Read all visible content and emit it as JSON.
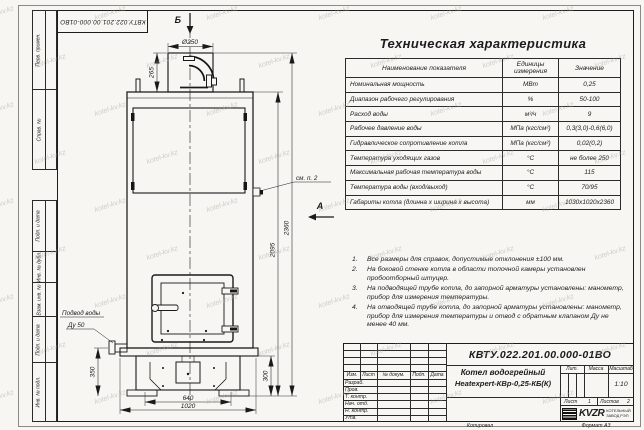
{
  "corner_stamp": "КВТУ.022.201.00.000-01ВО",
  "watermark_text": "kotel-kv.kz",
  "frame": {
    "left_labels_top": [
      "Перв. примен.",
      "Справ. №"
    ],
    "left_labels_bottom": [
      "Подп. и дата",
      "Инв. № дубл.",
      "Взам. инв. №",
      "Подп. и дата",
      "Инв. № подл."
    ]
  },
  "drawing": {
    "view_b": "Б",
    "view_a": "А",
    "dims": {
      "chimney_dia": "Ø250",
      "chimney_h": "265",
      "body_h": "2095",
      "total_h": "2360",
      "inlet_h": "350",
      "base_h": "300",
      "inner_w": "640",
      "outer_w": "1020"
    },
    "callouts": {
      "see_note": "см. п. 2",
      "water_inlet_line1": "Подвод воды",
      "water_inlet_line2": "Ду 50"
    }
  },
  "spec_table": {
    "title": "Техническая характеристика",
    "headers": [
      "Наименование показателя",
      "Единицы измерения",
      "Значение"
    ],
    "rows": [
      [
        "Номинальная мощность",
        "МВт",
        "0,25"
      ],
      [
        "Диапазон рабочего регулирования",
        "%",
        "50-100"
      ],
      [
        "Расход воды",
        "м³/ч",
        "9"
      ],
      [
        "Рабочее давление воды",
        "МПа (кгс/см²)",
        "0,3(3,0)-0,6(6,0)"
      ],
      [
        "Гидравлическое сопротивление котла",
        "МПа (кгс/см²)",
        "0,02(0,2)"
      ],
      [
        "Температура уходящих газов",
        "°С",
        "не более 250"
      ],
      [
        "Максимальная рабочая температура воды",
        "°С",
        "115"
      ],
      [
        "Температура воды (вход/выход)",
        "°С",
        "70/95"
      ],
      [
        "Габариты котла (длинна х ширина х высота)",
        "мм",
        "1030х1020х2360"
      ]
    ]
  },
  "notes": [
    "Все размеры для справок, допустимые отклонения ±100 мм.",
    "На боковой стенке котла в области топочной камеры установлен пробоотборный штуцер.",
    "На подводящей трубе котла, до запорной арматуры установлены: манометр, прибор для измерения температуры.",
    "На отводящей трубе котла, до запорной арматуры установлены: манометр, прибор для измерения температуры и отвод с обратным клапаном Ду не менее 40 мм."
  ],
  "title_block": {
    "doc_number": "КВТУ.022.201.00.000-01ВО",
    "product_line1": "Котел водогрейный",
    "product_line2": "Heatexpert-КВр-0,25-КБ(К)",
    "header_cols": [
      "Изм.",
      "Лист",
      "№ докум.",
      "Подп.",
      "Дата"
    ],
    "row_labels": [
      "Разраб.",
      "Пров.",
      "Т. контр.",
      "Нач. отд.",
      "Н. контр.",
      "Утв."
    ],
    "lit_label": "Лит.",
    "mass_label": "Масса",
    "scale_label": "Масштаб",
    "scale_value": "1:10",
    "sheet_label": "Лист",
    "sheet_value": "1",
    "sheets_label": "Листов",
    "sheets_value": "2",
    "logo_text": "KVZR",
    "logo_caption_line1": "КОТЕЛЬНЫЙ",
    "logo_caption_line2": "ЗАВОД РЭП",
    "footer_copy": "Копировал",
    "footer_format": "Формат А3"
  }
}
